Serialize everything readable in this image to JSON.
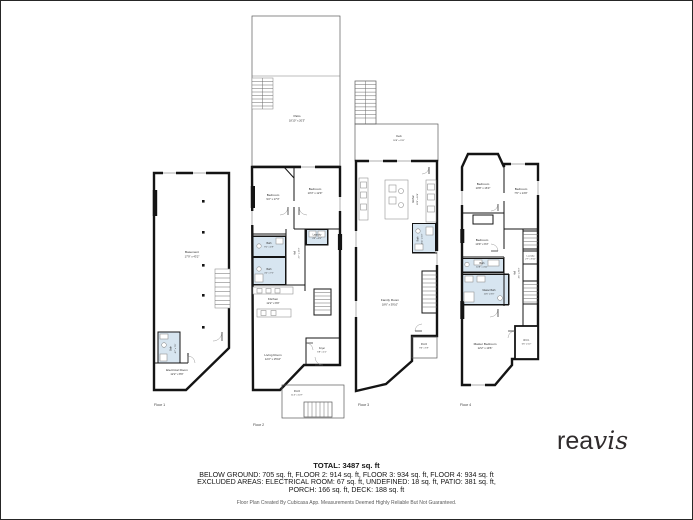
{
  "colors": {
    "wall": "#141414",
    "bath_fill": "#d7e5f0",
    "logo": "#2f2b2c",
    "footer_text": "#161616",
    "disclaimer_text": "#5a5a5a"
  },
  "branding": {
    "logo_part1": "rea",
    "logo_part2": "vis"
  },
  "floors": {
    "floor1": {
      "label": "Floor 1",
      "rooms": {
        "basement": {
          "name": "Basement",
          "dims": "17'9\" x 43'2\""
        },
        "bath": {
          "name": "Bath",
          "dims": "4'7\" x 7'9\""
        },
        "electrical_room": {
          "name": "Electrical Room",
          "dims": "12'2\" x 8'9\""
        }
      }
    },
    "floor2": {
      "label": "Floor 2",
      "rooms": {
        "patio": {
          "name": "Patio",
          "dims": "18'10\" x 20'3\""
        },
        "bedroom_left": {
          "name": "Bedroom",
          "dims": "9'2\" x 17'3\""
        },
        "bedroom_right": {
          "name": "Bedroom",
          "dims": "10'3\" x 12'9\""
        },
        "bath_upper": {
          "name": "Bath",
          "dims": "9'1\" x 4'9\""
        },
        "laundry": {
          "name": "Laundry",
          "dims": "4'3\" x 4'5\""
        },
        "hall": {
          "name": "Hall",
          "dims": "2'7\" x 17'3\""
        },
        "bath_lower": {
          "name": "Bath",
          "dims": "4'2\" x 7'5\""
        },
        "kitchen": {
          "name": "Kitchen",
          "dims": "12'2\" x 9'9\""
        },
        "living_room": {
          "name": "Living Room",
          "dims": "12'2\" x 15'10\""
        },
        "foyer": {
          "name": "Foyer",
          "dims": "6'8\" x 4'1\""
        },
        "porch": {
          "name": "Porch",
          "dims": "11'4\" x 10'7\""
        }
      }
    },
    "floor3": {
      "label": "Floor 3",
      "rooms": {
        "deck": {
          "name": "Deck",
          "dims": "18'8\" x 9'11\""
        },
        "kitchen": {
          "name": "Kitchen",
          "dims": "18'6\" x 16'4\""
        },
        "bath": {
          "name": "Bath",
          "dims": "4'11\" x 6'3\""
        },
        "family_room": {
          "name": "Family Room",
          "dims": "18'6\" x 39'10\""
        },
        "porch": {
          "name": "Porch",
          "dims": "9'6\" x 5'9\""
        }
      }
    },
    "floor4": {
      "label": "Floor 4",
      "rooms": {
        "bedroom_top": {
          "name": "Bedroom",
          "dims": "10'8\" x 16'3\""
        },
        "bedroom_right": {
          "name": "Bedroom",
          "dims": "7'6\" x 14'9\""
        },
        "bedroom_mid": {
          "name": "Bedroom",
          "dims": "10'9\" x 9'3\""
        },
        "laundry": {
          "name": "Laundry",
          "dims": "2'7\" x 8'11\""
        },
        "bath": {
          "name": "Bath",
          "dims": "10'8\" x 4'11\""
        },
        "master_bath": {
          "name": "Master Bath",
          "dims": "11'6\" x 8'3\""
        },
        "hall": {
          "name": "Hall",
          "dims": "4'6\" x 20'3\""
        },
        "wic": {
          "name": "W.I.C.",
          "dims": "6'6\" x 6'2\""
        },
        "master_bedroom": {
          "name": "Master Bedroom",
          "dims": "12'2\" x 19'6\""
        }
      }
    }
  },
  "footer": {
    "total": "TOTAL: 3487 sq. ft",
    "areas_line": "BELOW GROUND: 705 sq. ft, FLOOR 2: 914 sq. ft, FLOOR 3: 934 sq. ft, FLOOR 4: 934 sq. ft",
    "excluded_line1": "EXCLUDED AREAS: ELECTRICAL ROOM: 67 sq. ft, UNDEFINED: 18 sq. ft, PATIO: 381 sq. ft,",
    "excluded_line2": "PORCH: 166 sq. ft, DECK: 188 sq. ft",
    "disclaimer": "Floor Plan Created By Cubicasa App. Measurements Deemed Highly Reliable But Not Guaranteed."
  }
}
